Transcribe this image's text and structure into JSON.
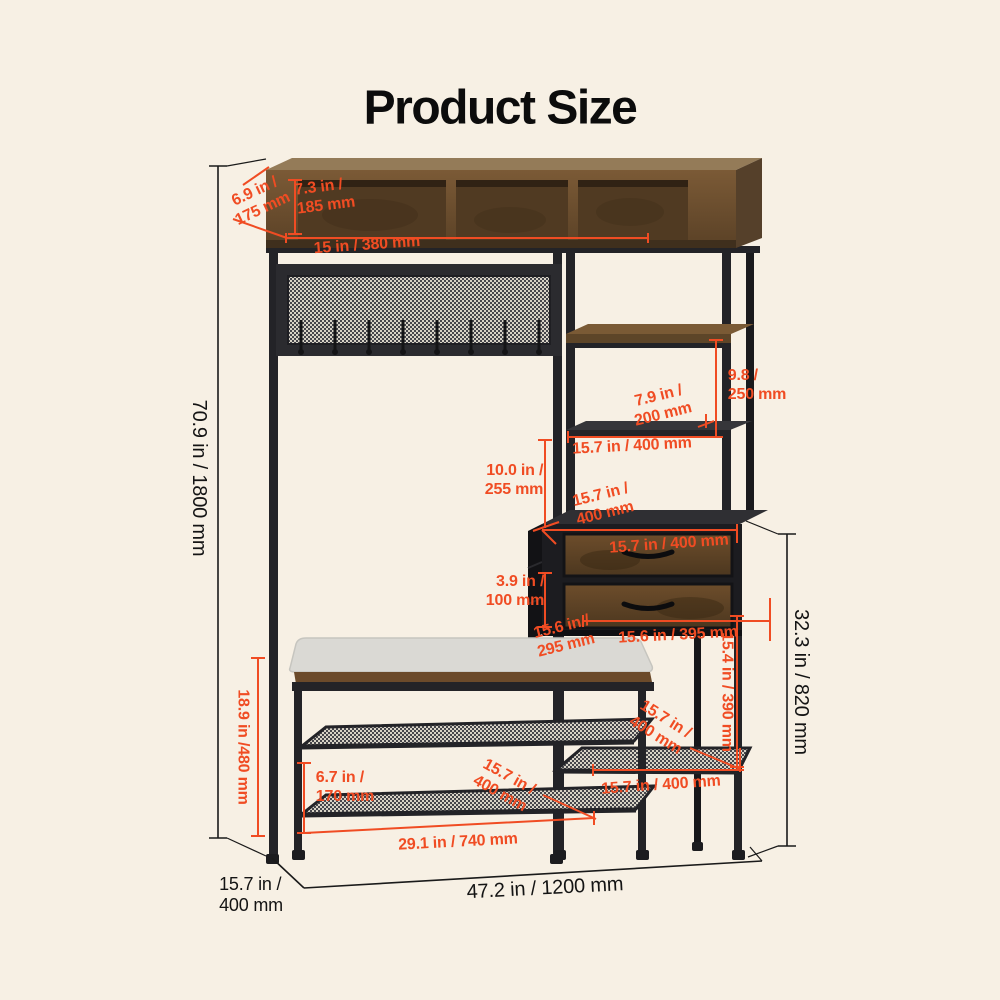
{
  "title": "Product Size",
  "colors": {
    "background": "#f7f0e4",
    "accent": "#f04c23",
    "ink": "#141414",
    "wood": "#6e5132",
    "wood_dark": "#4e3a22",
    "frame": "#232327",
    "cushion": "#dad9d4"
  },
  "dimensions": [
    {
      "name": "cabinet-depth",
      "text": "6.9 in /\n175 mm",
      "color": "accent",
      "x": 259,
      "y": 201,
      "rotate": -25,
      "align": "center",
      "size": 16
    },
    {
      "name": "cubby-height",
      "text": "7.3 in /\n185 mm",
      "color": "accent",
      "x": 325,
      "y": 197,
      "rotate": -7,
      "align": "left",
      "size": 16
    },
    {
      "name": "cubby-width",
      "text": "15 in / 380 mm",
      "color": "accent",
      "x": 367,
      "y": 246,
      "rotate": -4,
      "align": "center",
      "size": 16
    },
    {
      "name": "total-height",
      "text": "70.9 in / 1800 mm",
      "color": "ink",
      "x": 198,
      "y": 478,
      "rotate": 90,
      "align": "center",
      "size": 20
    },
    {
      "name": "upper-shelf-height",
      "text": "9.8 /\n250 mm",
      "color": "accent",
      "x": 757,
      "y": 386,
      "rotate": 0,
      "align": "left",
      "size": 16
    },
    {
      "name": "shelf-gap-height",
      "text": "7.9 in /\n200 mm",
      "color": "accent",
      "x": 661,
      "y": 406,
      "rotate": -14,
      "align": "center",
      "size": 16
    },
    {
      "name": "shelf-width",
      "text": "15.7 in / 400 mm",
      "color": "accent",
      "x": 632,
      "y": 447,
      "rotate": -3,
      "align": "center",
      "size": 16
    },
    {
      "name": "tower-gap-height",
      "text": "10.0 in /\n255 mm",
      "color": "accent",
      "x": 514,
      "y": 481,
      "rotate": 0,
      "align": "right",
      "size": 16
    },
    {
      "name": "tower-depth",
      "text": "15.7 in /\n400 mm",
      "color": "accent",
      "x": 603,
      "y": 505,
      "rotate": -14,
      "align": "center",
      "size": 16
    },
    {
      "name": "drawer-top-width",
      "text": "15.7 in / 400 mm",
      "color": "accent",
      "x": 669,
      "y": 545,
      "rotate": -4,
      "align": "center",
      "size": 16
    },
    {
      "name": "drawer-height",
      "text": "3.9 in /\n100 mm",
      "color": "accent",
      "x": 515,
      "y": 592,
      "rotate": 0,
      "align": "right",
      "size": 16
    },
    {
      "name": "bench-depth",
      "text": "15.6 in /\n295 mm",
      "color": "accent",
      "x": 564,
      "y": 637,
      "rotate": -14,
      "align": "center",
      "size": 16
    },
    {
      "name": "drawer-width",
      "text": "15.6 in / 395 mm",
      "color": "accent",
      "x": 678,
      "y": 636,
      "rotate": -3,
      "align": "center",
      "size": 16
    },
    {
      "name": "drawer-base-height",
      "text": "15.4 in / 390 mm",
      "color": "accent",
      "x": 726,
      "y": 692,
      "rotate": 90,
      "align": "center",
      "size": 16
    },
    {
      "name": "side-tower-height",
      "text": "32.3 in / 820 mm",
      "color": "ink",
      "x": 800,
      "y": 682,
      "rotate": 90,
      "align": "center",
      "size": 20
    },
    {
      "name": "bench-height",
      "text": "18.9 in /480 mm",
      "color": "accent",
      "x": 242,
      "y": 747,
      "rotate": 90,
      "align": "center",
      "size": 16
    },
    {
      "name": "shelf-spacing",
      "text": "6.7 in /\n170 mm",
      "color": "accent",
      "x": 345,
      "y": 788,
      "rotate": 0,
      "align": "left",
      "size": 16
    },
    {
      "name": "bench-shelf-depth",
      "text": "15.7 in /\n400 mm",
      "color": "accent",
      "x": 504,
      "y": 786,
      "rotate": 29,
      "align": "center",
      "size": 16
    },
    {
      "name": "bench-width",
      "text": "29.1 in / 740 mm",
      "color": "accent",
      "x": 458,
      "y": 843,
      "rotate": -3,
      "align": "center",
      "size": 16
    },
    {
      "name": "side-shelf-depth",
      "text": "15.7 in /\n400 mm",
      "color": "accent",
      "x": 660,
      "y": 728,
      "rotate": 32,
      "align": "center",
      "size": 16
    },
    {
      "name": "side-shelf-width",
      "text": "15.7 in / 400 mm",
      "color": "accent",
      "x": 661,
      "y": 786,
      "rotate": -4,
      "align": "center",
      "size": 16
    },
    {
      "name": "base-depth",
      "text": "15.7 in /\n400 mm",
      "color": "ink",
      "x": 251,
      "y": 895,
      "rotate": 0,
      "align": "left",
      "size": 18
    },
    {
      "name": "total-width",
      "text": "47.2 in / 1200 mm",
      "color": "ink",
      "x": 545,
      "y": 889,
      "rotate": -3,
      "align": "center",
      "size": 20
    }
  ]
}
